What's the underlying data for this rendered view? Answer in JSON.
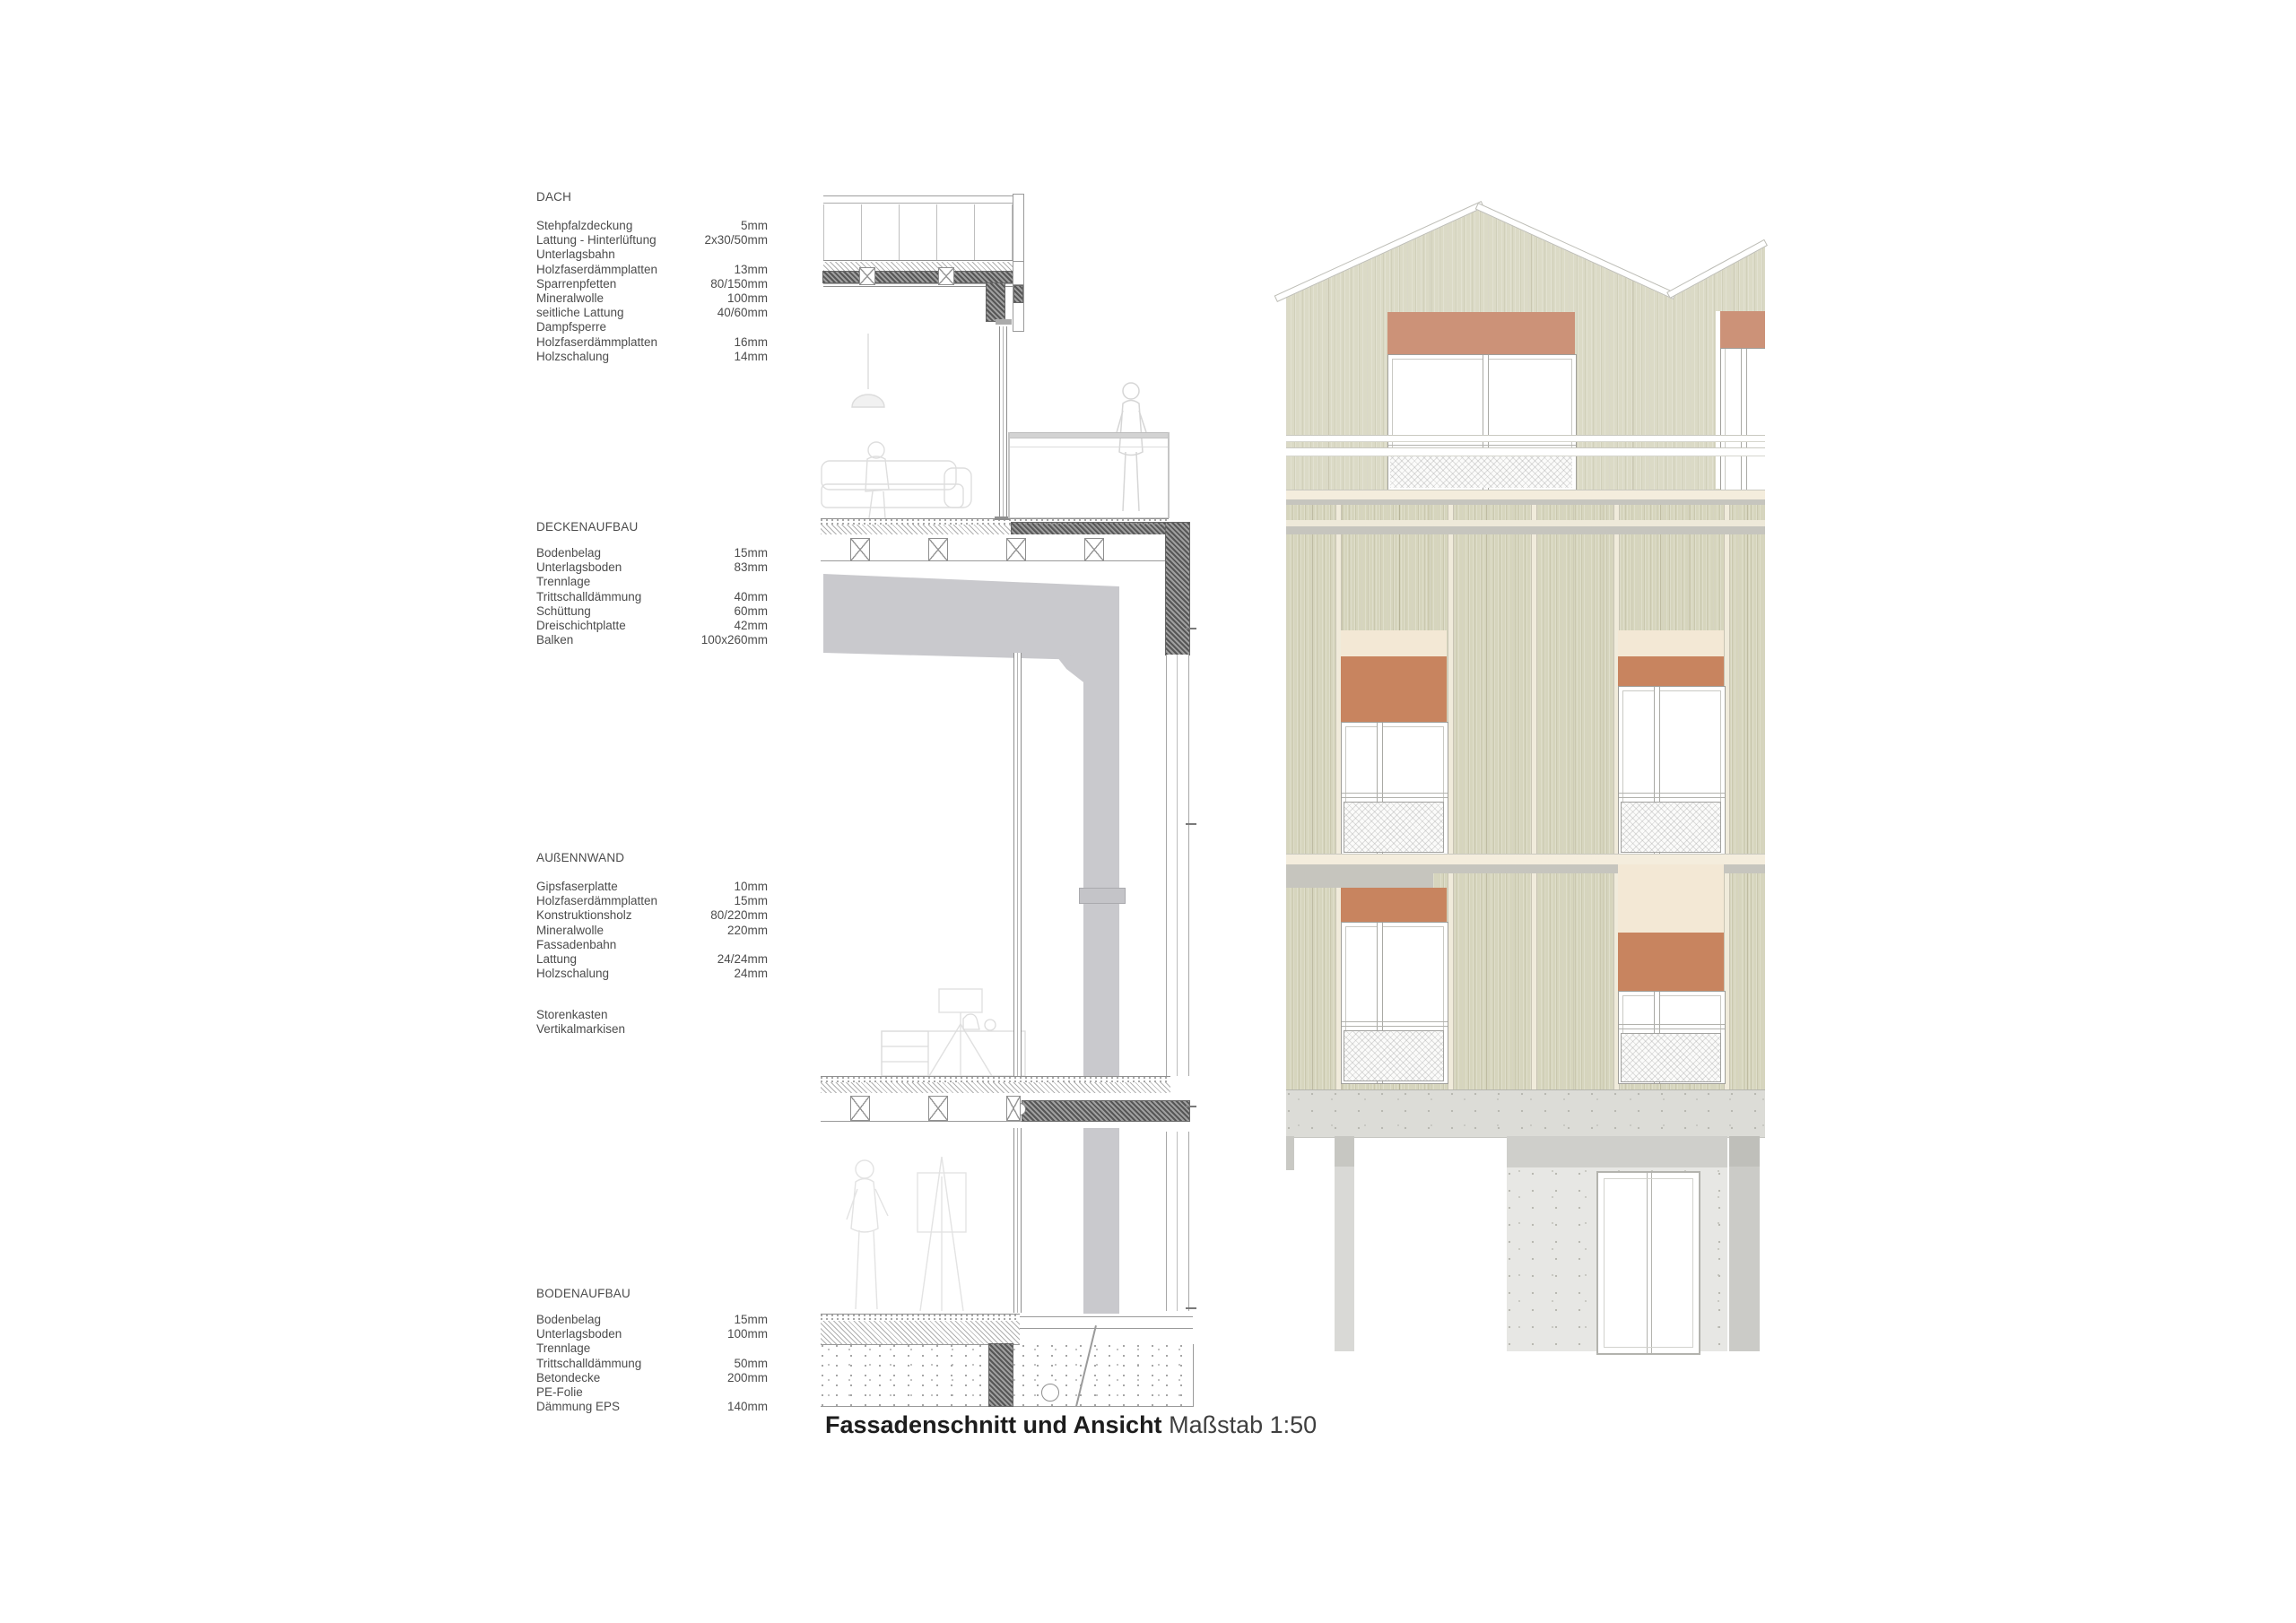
{
  "legend": {
    "sections": [
      {
        "title": "DACH",
        "rows": [
          [
            "Stehpfalzdeckung",
            "5mm"
          ],
          [
            "Lattung - Hinterlüftung",
            "2x30/50mm"
          ],
          [
            "Unterlagsbahn",
            ""
          ],
          [
            "Holzfaserdämmplatten",
            "13mm"
          ],
          [
            "Sparrenpfetten",
            "80/150mm"
          ],
          [
            "Mineralwolle",
            "100mm"
          ],
          [
            "seitliche Lattung",
            "40/60mm"
          ],
          [
            "Dampfsperre",
            ""
          ],
          [
            "Holzfaserdämmplatten",
            "16mm"
          ],
          [
            "Holzschalung",
            "14mm"
          ]
        ]
      },
      {
        "title": "DECKENAUFBAU",
        "rows": [
          [
            "Bodenbelag",
            "15mm"
          ],
          [
            "Unterlagsboden",
            "83mm"
          ],
          [
            "Trennlage",
            ""
          ],
          [
            "Trittschalldämmung",
            "40mm"
          ],
          [
            "Schüttung",
            "60mm"
          ],
          [
            "Dreischichtplatte",
            "42mm"
          ],
          [
            "Balken",
            "100x260mm"
          ]
        ]
      },
      {
        "title": "AUßENNWAND",
        "rows": [
          [
            "Gipsfaserplatte",
            "10mm"
          ],
          [
            "Holzfaserdämmplatten",
            "15mm"
          ],
          [
            "Konstruktionsholz",
            "80/220mm"
          ],
          [
            "Mineralwolle",
            "220mm"
          ],
          [
            "Fassadenbahn",
            ""
          ],
          [
            "Lattung",
            "24/24mm"
          ],
          [
            "Holzschalung",
            "24mm"
          ]
        ]
      },
      {
        "title": "BODENAUFBAU",
        "rows": [
          [
            "Bodenbelag",
            "15mm"
          ],
          [
            "Unterlagsboden",
            "100mm"
          ],
          [
            "Trennlage",
            ""
          ],
          [
            "Trittschalldämmung",
            "50mm"
          ],
          [
            "Betondecke",
            "200mm"
          ],
          [
            "PE-Folie",
            ""
          ],
          [
            "Dämmung EPS",
            "140mm"
          ]
        ]
      },
      {
        "title": "",
        "rows": []
      }
    ],
    "extra": [
      "Storenkasten",
      "Vertikalmarkisen"
    ]
  },
  "caption": {
    "bold": "Fassadenschnitt und Ansicht",
    "regular": "Maßstab 1:50"
  },
  "colors": {
    "awning": "#c8845f",
    "awning_light": "#cc9278",
    "blindbox_cream": "#f3e8d5",
    "floorband_cream": "#f4eddd",
    "shadow_gray": "#c6c5be",
    "slab_concrete": "#dcdcd7",
    "ground_wall": "#e7e7e4",
    "ground_wall_cap": "#cfcfcb",
    "column_gray": "#d9d9d6",
    "column_cap": "#c7c7c2",
    "section_gray": "#c9c9cd"
  }
}
